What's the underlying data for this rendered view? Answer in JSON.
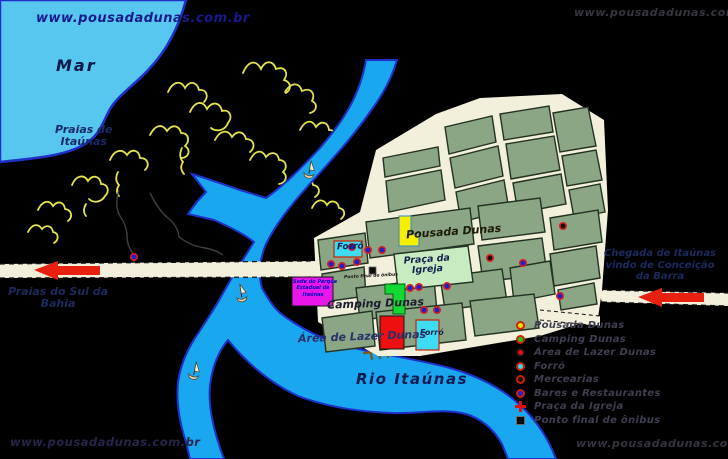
{
  "watermarks": {
    "top_left": "www.pousadadunas.com.br",
    "top_right": "www.pousadadunas.com.br",
    "bottom_left": "www.pousadadunas.com.br",
    "bottom_right": "www.pousadadunas.com.br"
  },
  "labels": {
    "sea": "Mar",
    "beaches_line1": "Praias de",
    "beaches_line2": "Itaúnas",
    "river": "Rio Itaúnas",
    "road_west_line1": "Praias do Sul da",
    "road_west_line2": "Bahia",
    "road_east_line1": "Chegada de Itaúnas",
    "road_east_line2": "vindo de Conceição",
    "road_east_line3": "da Barra",
    "pousada": "Pousada Dunas",
    "forro_main": "Forró",
    "forro_south": "Forró",
    "praca_line1": "Praça da",
    "praca_line2": "Igreja",
    "camping": "Camping Dunas",
    "lazer": "Área de Lazer Dunas",
    "sede_line1": "Sede do Parque",
    "sede_line2": "Estadual de",
    "sede_line3": "Itaúnas",
    "bus_stop": "Ponto final de ônibus"
  },
  "legend": {
    "items": [
      {
        "icon": "yellow-circle",
        "color": "#f2e400",
        "label": "Pousada Dunas"
      },
      {
        "icon": "green-circle",
        "color": "#18cc22",
        "label": "Camping Dunas"
      },
      {
        "icon": "red-circle",
        "color": "#ee1111",
        "label": "Área de Lazer Dunas"
      },
      {
        "icon": "cyan-circle",
        "color": "#35daf0",
        "label": "Forró"
      },
      {
        "icon": "dark-circle",
        "color": "#1a0d0d",
        "label": "Mercearias"
      },
      {
        "icon": "blue-circle",
        "color": "#2222cc",
        "label": "Bares e Restaurantes"
      },
      {
        "icon": "red-cross",
        "color": "#e01010",
        "label": "Praça da Igreja"
      },
      {
        "icon": "black-square",
        "color": "#0a0a0a",
        "label": "Ponto final de ônibus"
      }
    ]
  },
  "colors": {
    "background": "#000000",
    "sea": "#57c7f0",
    "river": "#19a7ef",
    "water_border": "#1f2fc8",
    "dunes": "#e6e350",
    "street": "#f2efda",
    "block": "#8ba684",
    "plaza": "#c9ebc1",
    "arrow": "#e82010",
    "building_pousada": "#f6f000",
    "building_camping": "#11d832",
    "building_lazer": "#ee1010",
    "building_forro": "#3ddcf2",
    "building_sede": "#e816e8"
  }
}
